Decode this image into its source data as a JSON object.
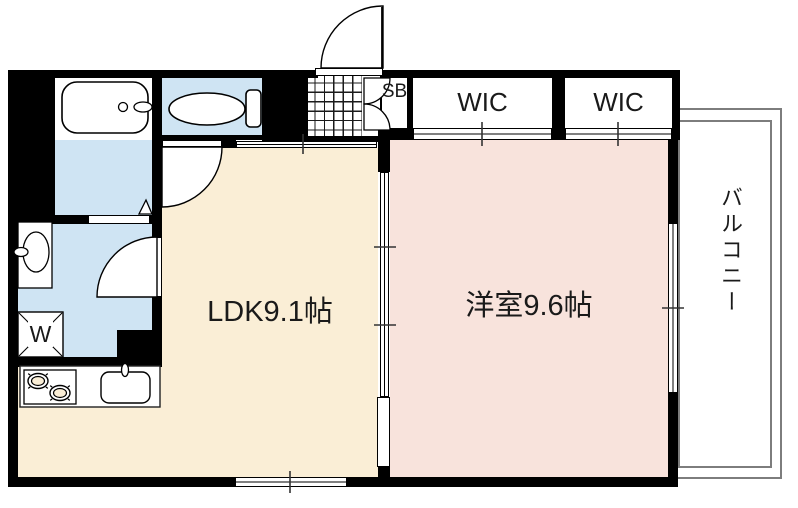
{
  "plan": {
    "rooms": {
      "ldk": {
        "label": "LDK9.1帖"
      },
      "bedroom": {
        "label": "洋室9.6帖"
      },
      "wic1": {
        "label": "WIC"
      },
      "wic2": {
        "label": "WIC"
      },
      "shoe_box": {
        "label": "SB"
      },
      "balcony": {
        "label": "バルコニー"
      }
    },
    "fixtures": {
      "washing_machine_label": "W"
    },
    "colors": {
      "wall": "#000000",
      "ldk_floor": "#faeed6",
      "bedroom_floor": "#f8e3dc",
      "wet_area_floor": "#cfe4f3",
      "balcony_line": "#7d7d7d"
    }
  }
}
